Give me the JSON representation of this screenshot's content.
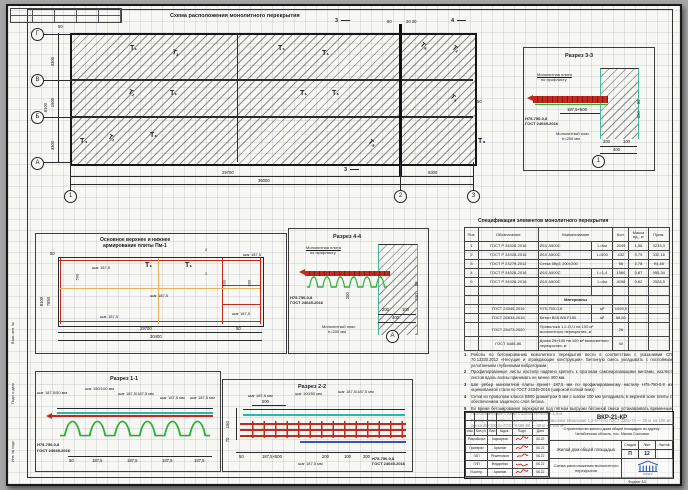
{
  "colors": {
    "rebar_red": "#c2291f",
    "deck_green": "#2fae3a",
    "mesh_teal": "#2db5a5",
    "aux_blue": "#3a50c0",
    "logo_blue": "#2d5fb0",
    "sig_red": "#c22222"
  },
  "sheet": {
    "format": "Формат А3",
    "side_labels": [
      "Взам. инв. №",
      "Подп. и дата",
      "Инв. № подл."
    ]
  },
  "plan": {
    "title": "Схема расположения монолитного перекрытия",
    "axes": [
      "Г",
      "В",
      "Б",
      "А"
    ],
    "cols": [
      "1",
      "2",
      "3"
    ],
    "dims_bottom": [
      "29700",
      "6300",
      "36000"
    ],
    "dims_left": [
      "3300",
      "1500",
      "3300",
      "8100"
    ],
    "off50": "50",
    "off20": "20 20",
    "right50": "50",
    "sec3": "3",
    "sec4": "4",
    "marks": [
      "Т₁",
      "Т₁",
      "Т₁",
      "Т₁",
      "Т₄",
      "Т₁",
      "Т₁",
      "Т₁",
      "Т₁",
      "Т₁",
      "Т₄",
      "Т₁",
      "Т₁",
      "Т₃",
      "Т₄",
      "Т₃"
    ]
  },
  "pm1": {
    "title1": "Основное верхнее и нижнее",
    "title2": "армирование плиты Пм-1",
    "step": "шаг 187,5",
    "dim500": "500",
    "dim50": "50",
    "flag2": "2",
    "mark": "Т₁",
    "dims_bottom": [
      "29700",
      "50",
      "30400"
    ],
    "dims_left": [
      "7850",
      "8100"
    ]
  },
  "s44": {
    "title": "Разрез 4-4",
    "plate1": "Монолитная плита",
    "plate2": "по профлисту",
    "sheet1": "Н75-750-0,8",
    "sheet2": "ГОСТ 24045-2016",
    "belt1": "Монолитный пояс",
    "belt2": "h=200 мм",
    "dim200": "200",
    "dims": [
      "200",
      "100",
      "400"
    ],
    "side_dims": [
      "50",
      "150"
    ],
    "axis": "А"
  },
  "s33": {
    "title": "Разрез 3-3",
    "plate1": "Монолитная плита",
    "plate2": "по профлисту",
    "sheet1": "Н75-750-0,8",
    "sheet2": "ГОСТ 24045-2016",
    "belt1": "Монолитный пояс",
    "belt2": "h=200 мм",
    "step_dim": "187,5×500",
    "dims": [
      "200",
      "100",
      "400"
    ],
    "side_dims": [
      "50",
      "150"
    ],
    "axis": "1"
  },
  "s11": {
    "title": "Разрез 1-1",
    "callouts": [
      "шаг 187,5/50 мм",
      "шаг 150/100 мм",
      "шаг 187,5/187,5 мм",
      "шаг 187,5 мм",
      "шаг 187,5 мм"
    ],
    "sheet1": "Н75-750-0,8",
    "sheet2": "ГОСТ 24045-2016",
    "dims": [
      "50",
      "187,5",
      "187,5",
      "187,5",
      "187,5"
    ]
  },
  "s22": {
    "title": "Разрез 2-2",
    "callouts": [
      "шаг 187,5 мм",
      "шаг 100/50 мм",
      "шаг 187,5/187,5 мм"
    ],
    "dim500": "500",
    "left_dims": [
      "150",
      "70"
    ],
    "dims_bottom": [
      "50",
      "187,5×500",
      "200",
      "100",
      "200"
    ],
    "bottom_callout": "шаг 187,5 мм",
    "sheet1": "Н75-750-0,8",
    "sheet2": "ГОСТ 24045-2016"
  },
  "spec": {
    "title": "Спецификация элементов монолитного перекрытия",
    "headers": [
      "Поз.",
      "Обозначение",
      "Наименование",
      "Кол.",
      "Масса ед., кг",
      "Прим."
    ],
    "rows": [
      {
        "pos": "1",
        "doc": "ГОСТ Р 34028-2016",
        "name": "Ø10 А500С",
        "len": "L=6м",
        "qty": "2049",
        "mass": "1,58",
        "note": "3233,3"
      },
      {
        "pos": "2",
        "doc": "ГОСТ Р 34028-2016",
        "name": "Ø10 А500С",
        "len": "L=500",
        "qty": "432",
        "mass": "0,79",
        "note": "332,16"
      },
      {
        "pos": "3",
        "doc": "ГОСТ Р 23279-2012",
        "name": "Сетка 5Вр1 200×200",
        "len": "",
        "qty": "56",
        "mass": "2,78",
        "note": "94,48"
      },
      {
        "pos": "4",
        "doc": "ГОСТ Р 34028-2016",
        "name": "Ø10 А500С",
        "len": "L=1,4",
        "qty": "1560",
        "mass": "0,87",
        "note": "955,34"
      },
      {
        "pos": "5",
        "doc": "ГОСТ Р 34028-2016",
        "name": "Ø10 А500С",
        "len": "L=4м",
        "qty": "4098",
        "mass": "0,62",
        "note": "2528,5"
      }
    ],
    "materials_header": "Материалы",
    "materials": [
      {
        "doc": "ГОСТ 24045-2016",
        "name": "Н75-750-0,8",
        "unit": "м²",
        "qty": "1059,5"
      },
      {
        "doc": "ГОСТ 26633-2015",
        "name": "Бетон В25 W6 F150",
        "unit": "м³",
        "qty": "56,50"
      },
      {
        "doc": "ГОСТ 25473-2020",
        "name": "Проволока 1,2-О-Ч на 100 м² монолитного перекрытия, кг",
        "unit": "",
        "qty": "26"
      },
      {
        "doc": "ГОСТ 8486-86",
        "name": "Доска 25×100 на 100 м² монолитного перекрытия, кг",
        "unit": "",
        "qty": "40"
      }
    ]
  },
  "notes": {
    "items": [
      "Работы по бетонированию монолитного перекрытия вести в соответствии с указаниями СП 70.13330.2012 «Несущие и ограждающие конструкции». Бетонную смесь укладывать с послойным уплотнением глубинными вибраторами.",
      "Профилированные листы настила надёжно крепить к прогонам самонарезающими винтами, нахлёст листов вдоль волны принимать не менее 300 мм.",
      "Шаг рёбер монолитной плиты принят 187,5 мм по профилированному настилу Н75-750-0,8 из оцинкованной стали по ГОСТ 24045-2016 (широкой полкой вниз).",
      "Сетки из проволоки класса В500 диаметром 5 мм с шагом 100 мм укладывать в верхней зоне плиты с обеспечением защитного слоя бетона.",
      "Во время бетонирования перекрытия под пятном выгрузки бетонной смеси устанавливать временные телескопические стойки с шагом не более 1,5 м.",
      "Расход вспомогательных материалов: проволока вязальная 1,2-О-Ч по ГОСТ 3282-74 — 26 кг на 100 м², доска 25×100 по ГОСТ 8486-86 — 40 кг на 100 м²."
    ]
  },
  "stamp": {
    "doc_code": "ВКР-21-КР",
    "project_line1": "Строительство жилого дома общей площадью по адресу:",
    "project_line2": "Челябинская область, пос. Малая Сосновка",
    "object_label": "Жилой дом общей площадью",
    "drawing_title": "Схема расположения монолитного перекрытия",
    "stage_label": "Стадия",
    "sheet_label": "Лист",
    "sheets_label": "Листов",
    "stage": "П",
    "sheet_no": "12",
    "sheets_total": "",
    "header_cols": [
      "Изм.",
      "Кол.уч.",
      "Лист",
      "№док.",
      "Подп.",
      "Дата"
    ],
    "sign_rows": [
      {
        "role": "Разработал",
        "name": "Карнаухов",
        "date": "06.22"
      },
      {
        "role": "Проверил",
        "name": "Архипов",
        "date": "06.22"
      },
      {
        "role": "ГАП",
        "name": "Решетников",
        "date": "06.22"
      },
      {
        "role": "ГИП",
        "name": "Федоренко",
        "date": "06.22"
      },
      {
        "role": "Н.контр.",
        "name": "Архипов",
        "date": "06.22"
      }
    ],
    "logo_caption": "ЮУрГУ"
  }
}
